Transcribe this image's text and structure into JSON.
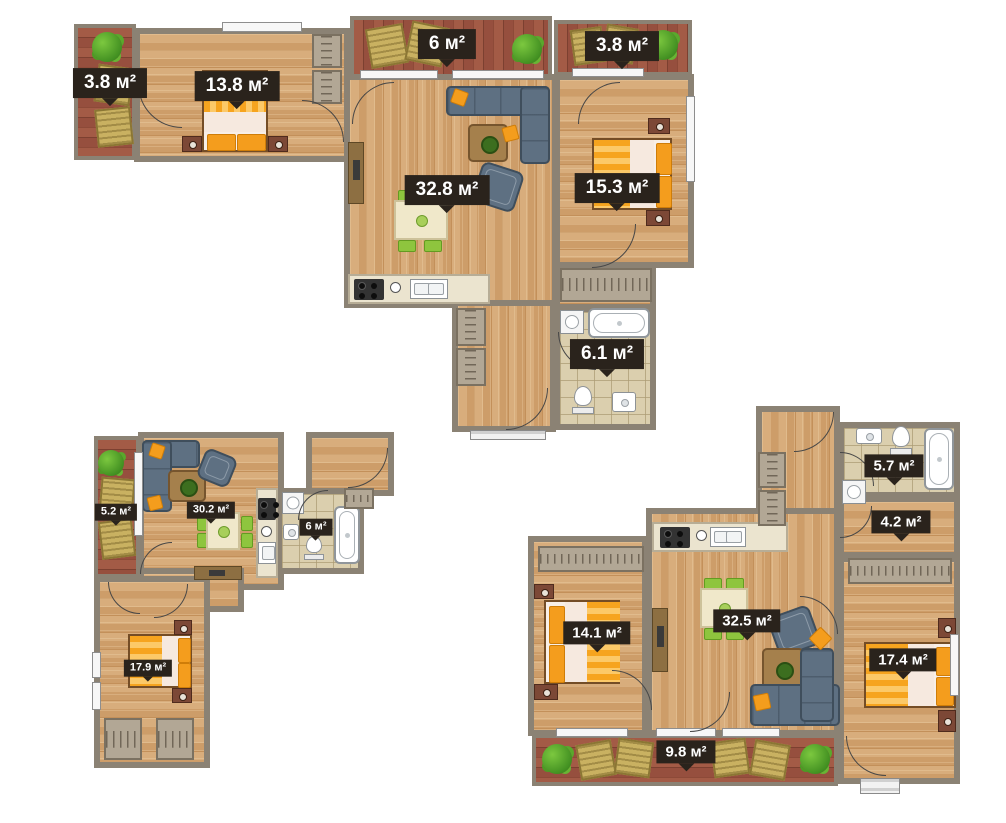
{
  "page": {
    "background": "#ffffff",
    "type": "residential floor plans"
  },
  "palette": {
    "wall": "#8b8274",
    "wood_floor": "#d2a470",
    "deck": "#99523f",
    "tile": "#dbcfae",
    "label_bg": "#2a231c",
    "label_text": "#ffffff",
    "accent_orange": "#f5a21c",
    "sofa_blue": "#5e7082",
    "chair_green": "#8ec53e"
  },
  "apartments": [
    {
      "id": "apartment-top",
      "rooms": [
        {
          "key": "balcony-left",
          "area": "3.8 м²"
        },
        {
          "key": "bedroom-1",
          "area": "13.8 м²"
        },
        {
          "key": "balcony-top",
          "area": "6 м²"
        },
        {
          "key": "balcony-top-right",
          "area": "3.8 м²"
        },
        {
          "key": "living-kitchen",
          "area": "32.8 м²"
        },
        {
          "key": "bedroom-2",
          "area": "15.3 м²"
        },
        {
          "key": "bathroom",
          "area": "6.1 м²"
        }
      ]
    },
    {
      "id": "apartment-bottom-left",
      "rooms": [
        {
          "key": "balcony",
          "area": "5.2 м²"
        },
        {
          "key": "living-kitchen",
          "area": "30.2 м²"
        },
        {
          "key": "bathroom",
          "area": "6 м²"
        },
        {
          "key": "bedroom",
          "area": "17.9 м²"
        }
      ]
    },
    {
      "id": "apartment-bottom-right",
      "rooms": [
        {
          "key": "bathroom",
          "area": "5.7 м²"
        },
        {
          "key": "dressing",
          "area": "4.2 м²"
        },
        {
          "key": "bedroom-1",
          "area": "14.1 м²"
        },
        {
          "key": "living-kitchen",
          "area": "32.5 м²"
        },
        {
          "key": "bedroom-2",
          "area": "17.4 м²"
        },
        {
          "key": "balcony",
          "area": "9.8 м²"
        }
      ]
    }
  ]
}
